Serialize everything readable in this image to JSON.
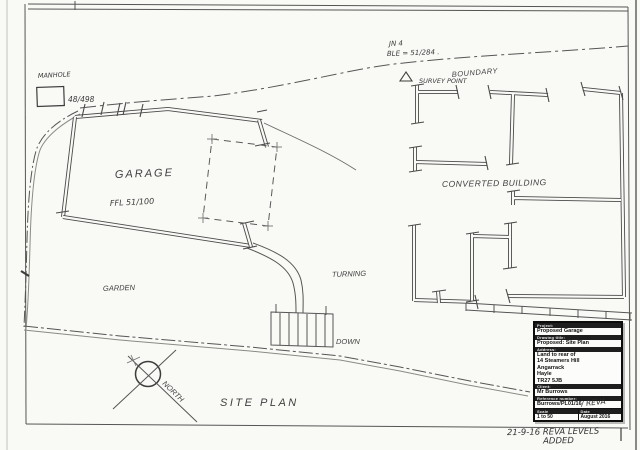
{
  "page": {
    "paper_color": "#f9f9f6",
    "ink_color": "#4a4a4a"
  },
  "plan": {
    "labels": {
      "manhole": "MANHOLE",
      "manhole_ref": "48/498",
      "jn": "JN 4",
      "ble": "BLE = 51/284 .",
      "boundary": "BOUNDARY",
      "survey_point": "SURVEY POINT",
      "garage": "GARAGE",
      "ffl": "FFL 51/100",
      "converted_building": "CONVERTED  BUILDING",
      "garden": "GARDEN",
      "turning": "TURNING",
      "down": "DOWN",
      "site_plan": "SITE  PLAN",
      "north": "NORTH"
    },
    "revision_note": {
      "line1": "21-9-16 REVA LEVELS",
      "line2": "ADDED"
    }
  },
  "title_block": {
    "project_label": "Project:",
    "project": "Proposed Garage",
    "drawing_title_label": "Drawing title:",
    "drawing_title": "Proposed: Site Plan",
    "address_label": "Address:",
    "address_lines": [
      "Land to rear of",
      "14 Steamers Hill",
      "Angarrack",
      "Hayle",
      "TR27 5JB"
    ],
    "client_label": "Client:",
    "client": "Mr Burrows",
    "reference_label": "Reference number:",
    "reference": "Burrows/PL01/16",
    "reference_handwritten": "/ REVA",
    "scale_label": "Scale",
    "scale": "1 to 50",
    "date_label": "Date",
    "date": "August 2016"
  }
}
